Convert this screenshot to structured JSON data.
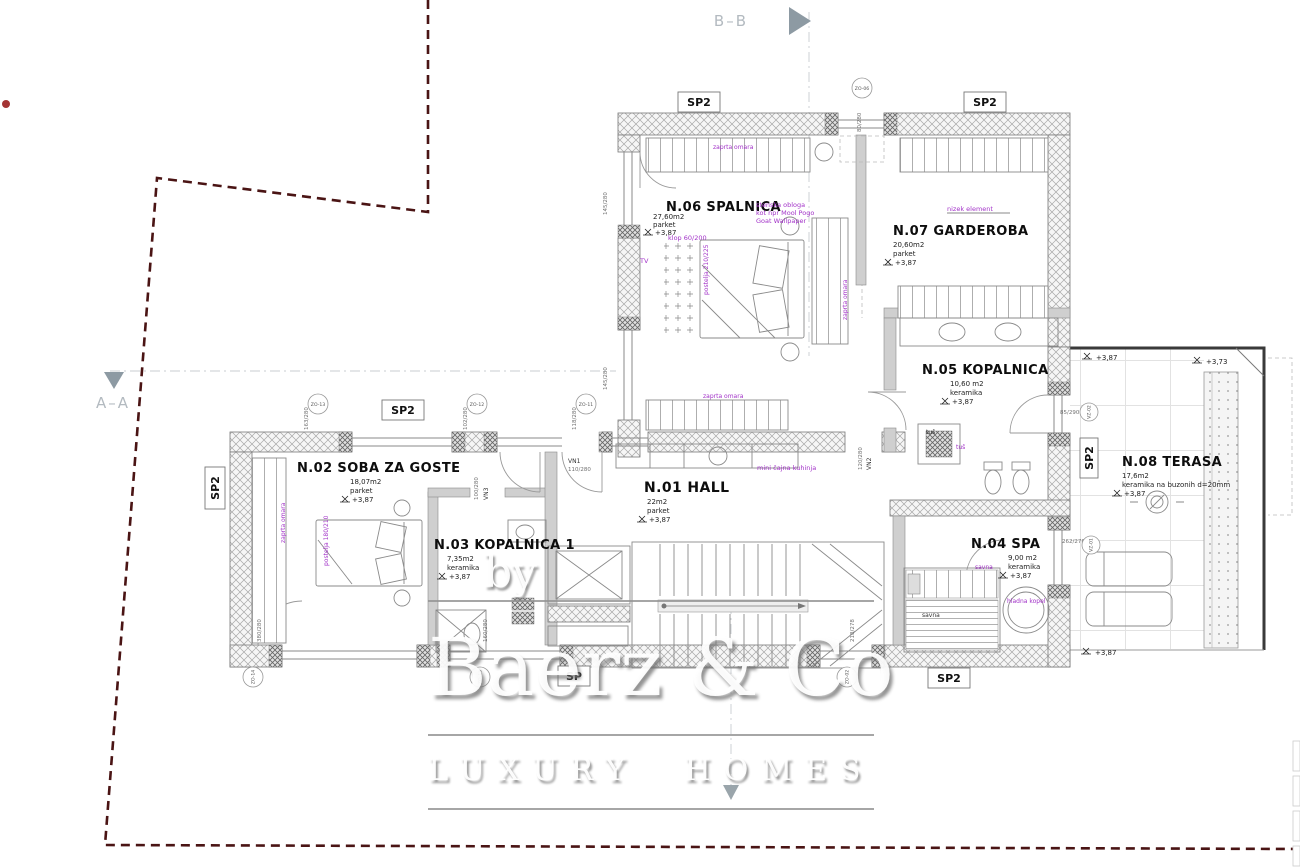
{
  "colors": {
    "boundary": "#4a1414",
    "annotation_purple": "#a232c8",
    "watermark_gray": "#8f8f8f",
    "section_marker_gray": "#8d9aa3",
    "wall_hatch": "#a8a8a8",
    "boundary_dot": "#a43434"
  },
  "watermark": {
    "by": "by",
    "brand": "Baerz & Co",
    "tagline": "LUXURY HOMES"
  },
  "section_markers": {
    "top": "B–B",
    "left": "A–A"
  },
  "rooms": {
    "n01": {
      "name": "N.01 HALL",
      "area": "22m2",
      "material": "parket",
      "level": "+3,87"
    },
    "n02": {
      "name": "N.02 SOBA ZA GOSTE",
      "area": "18,07m2",
      "material": "parket",
      "level": "+3,87"
    },
    "n03": {
      "name": "N.03 KOPALNICA 1",
      "area": "7,35m2",
      "material": "keramika",
      "level": "+3,87"
    },
    "n04": {
      "name": "N.04 SPA",
      "area": "9,00 m2",
      "material": "keramika",
      "level": "+3,87"
    },
    "n05": {
      "name": "N.05 KOPALNICA",
      "area": "10,60 m2",
      "material": "keramika",
      "level": "+3,87"
    },
    "n06": {
      "name": "N.06 SPALNICA",
      "area": "27,60m2",
      "material": "parket",
      "level": "+3,87"
    },
    "n07": {
      "name": "N.07 GARDEROBA",
      "area": "20,60m2",
      "material": "parket",
      "level": "+3,87"
    },
    "n08": {
      "name": "N.08 TERASA",
      "area": "17,6m2",
      "material": "keramika na buzonih d=20mm",
      "level": "+3,87"
    }
  },
  "annotations": {
    "wall_finish_1": "stenska obloga",
    "wall_finish_2": "kot npr Mool Pogo",
    "wall_finish_3": "Goat Wallpaper",
    "bench": "klop 60/200",
    "bed_master": "postelja 210/225",
    "tv": "TV",
    "closet_top": "zaprta omara",
    "closet_right": "zaprta omara",
    "closet_lower": "zaprta omara",
    "closet_guest": "zaprta omara",
    "low_element": "nizek element",
    "kitchenette": "mini čajna kuhinja",
    "bed_guest": "postelja 180/210",
    "shower_black": "tuš",
    "shower_purple": "tuš",
    "sauna_purple": "savna",
    "sauna_black": "savna",
    "cold_bath": "hladna kopel"
  },
  "levels": {
    "terrace_left": "+3,87",
    "terrace_right": "+3,73",
    "terrace_bottom": "+3,87"
  },
  "plates": {
    "sp2": "SP2",
    "sp": "SP"
  },
  "openings": {
    "zo06": {
      "code": "ZO-06",
      "dim": "80/280"
    },
    "zo13": {
      "code": "ZO-13",
      "dim": "163/280"
    },
    "zo12": {
      "code": "ZO-12",
      "dim": "102/280"
    },
    "zo11": {
      "code": "ZO-11",
      "dim": "118/280"
    },
    "zo14": {
      "code": "ZO-14",
      "dim": "380/280"
    },
    "zo15": {
      "code": "ZO-15",
      "dim": "160/280"
    },
    "zo02": {
      "code": "ZO-02",
      "dim": "218/278"
    },
    "vz01": {
      "code": "VZ-01",
      "dim": "262/278"
    },
    "vz02": {
      "code": "VZ-02",
      "dim": "85/290"
    },
    "vn1": {
      "code": "VN1",
      "dim": "110/280"
    },
    "vn2": {
      "code": "VN2",
      "dim": "120/280"
    },
    "vn3": {
      "code": "VN3",
      "dim": "100/280"
    },
    "w145a": {
      "dim": "145/280"
    },
    "w145b": {
      "dim": "145/280"
    }
  }
}
